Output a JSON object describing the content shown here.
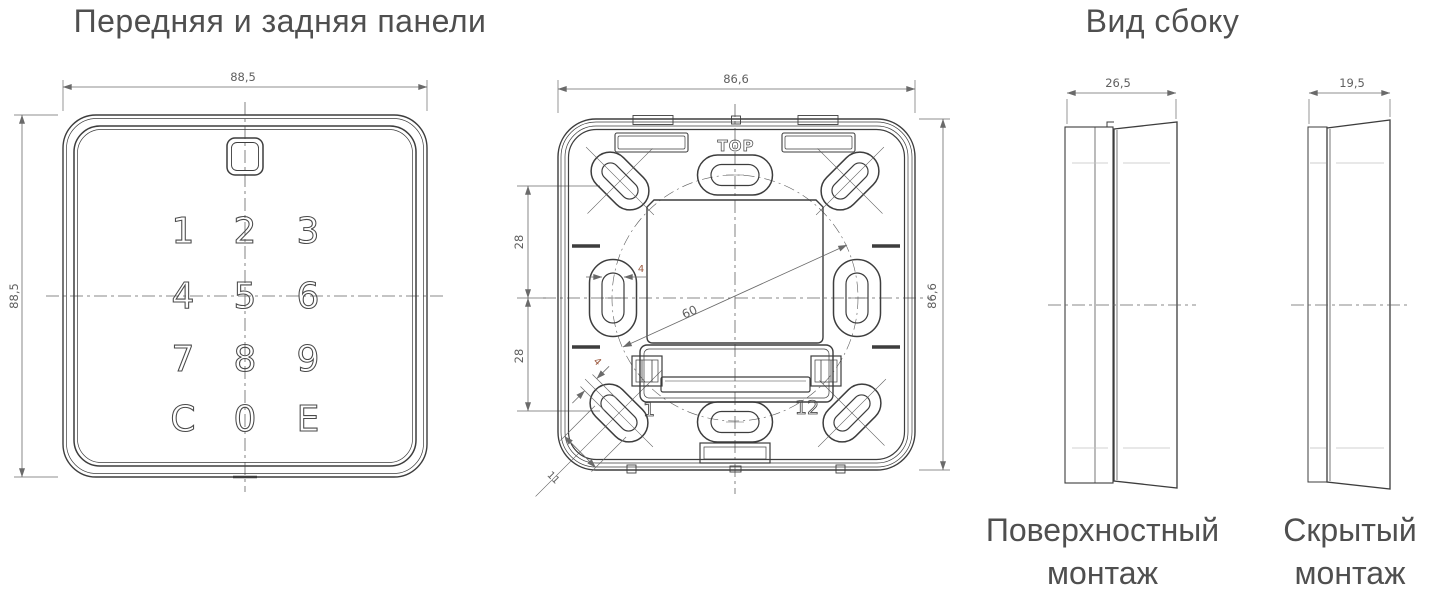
{
  "titles": {
    "front_rear": "Передняя и задняя панели",
    "side": "Вид сбоку"
  },
  "front_panel": {
    "width_dim": "88,5",
    "height_dim": "88,5",
    "keys": [
      "1",
      "2",
      "3",
      "4",
      "5",
      "6",
      "7",
      "8",
      "9",
      "C",
      "0",
      "E"
    ]
  },
  "rear_panel": {
    "width_dim": "86,6",
    "height_dim": "86,6",
    "upper_spacing_dim": "28",
    "lower_spacing_dim": "28",
    "slot_width_dim": "4",
    "slot_width_diag_dim": "4",
    "slot_length_dim": "11",
    "mounting_circle_dim": "60",
    "orientation_label": "TOP",
    "terminal_first_label": "1",
    "terminal_last_label": "12"
  },
  "side_views": {
    "surface": {
      "depth_dim": "26,5",
      "caption": [
        "Поверхностный",
        "монтаж"
      ]
    },
    "flush": {
      "depth_dim": "19,5",
      "caption": [
        "Скрытый",
        "монтаж"
      ]
    }
  },
  "colors": {
    "outline": "#3d3d3d",
    "dimension": "#6a6a6a",
    "dimension_text": "#5f5f5f",
    "accent_dimension_text": "#9c5b41",
    "title_text": "#4f4f4f"
  }
}
